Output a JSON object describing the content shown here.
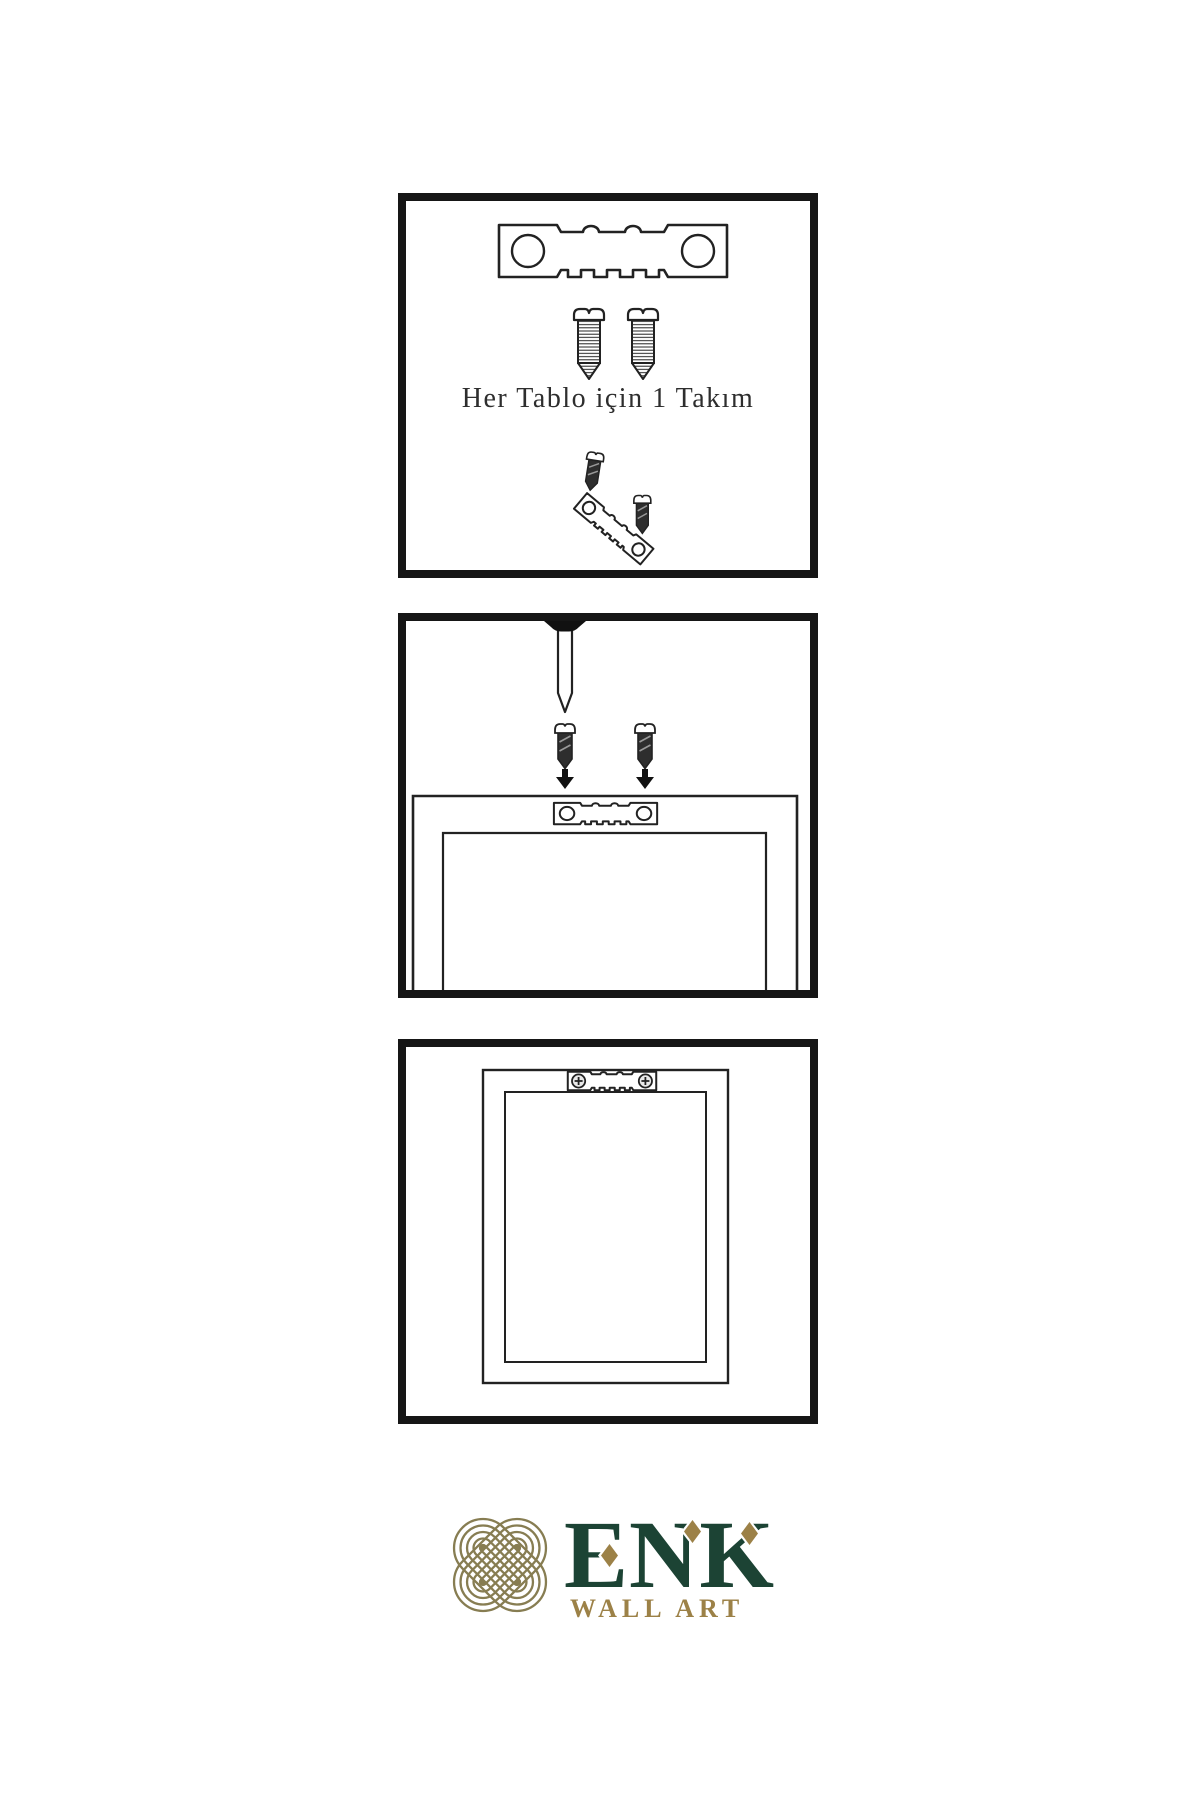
{
  "document": {
    "type": "wall-art hanging instruction sheet",
    "background": "#ffffff"
  },
  "colors": {
    "ink": "#222222",
    "panel_border": "#161616",
    "logo_green": "#1c4334",
    "logo_gold": "#9c8147",
    "logo_knot": "#877d52"
  },
  "step1": {
    "caption": "Her Tablo için 1 Takım",
    "icons": [
      "sawtooth-hanger-icon",
      "screw-icon",
      "screw-icon",
      "tilted-hanger-with-screws-icon"
    ]
  },
  "step2": {
    "icons": [
      "nail-in-wall-icon",
      "screw-icon",
      "screw-icon",
      "arrow-down-icon",
      "arrow-down-icon",
      "frame-back-with-sawtooth-hanger-icon"
    ]
  },
  "step3": {
    "icons": [
      "frame-back-icon",
      "mounted-sawtooth-hanger-icon"
    ]
  },
  "logo": {
    "name": "ENK",
    "subtitle": "WALL ART",
    "mark": "interlocking-knot-icon"
  }
}
